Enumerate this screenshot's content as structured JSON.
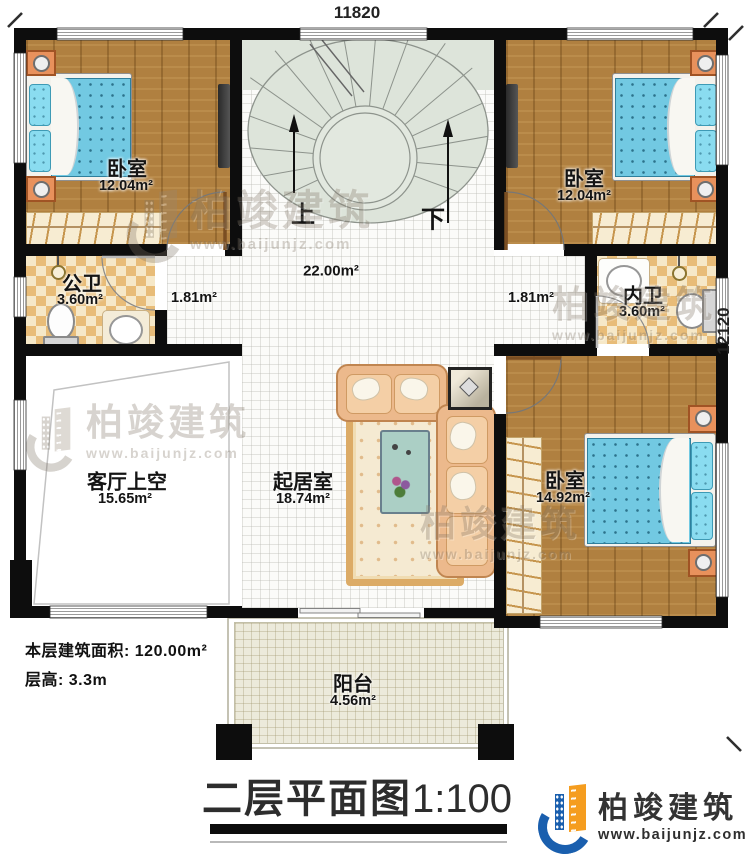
{
  "dimensions": {
    "top": "11820",
    "right": "12120"
  },
  "stair": {
    "up": "上",
    "down": "下"
  },
  "areas": {
    "stair_hall": "22.00m²",
    "hall_left": "1.81m²",
    "hall_right": "1.81m²"
  },
  "rooms": {
    "bedroom_tl": {
      "label": "卧室",
      "area": "12.04m²"
    },
    "bedroom_tr": {
      "label": "卧室",
      "area": "12.04m²"
    },
    "bedroom_br": {
      "label": "卧室",
      "area": "14.92m²"
    },
    "public_bath": {
      "label": "公卫",
      "area": "3.60m²"
    },
    "ensuite_bath": {
      "label": "内卫",
      "area": "3.60m²"
    },
    "living_void": {
      "label": "客厅上空",
      "area": "15.65m²"
    },
    "family_room": {
      "label": "起居室",
      "area": "18.74m²"
    },
    "balcony": {
      "label": "阳台",
      "area": "4.56m²"
    }
  },
  "info": {
    "floor_area": "本层建筑面积: 120.00m²",
    "floor_height": "层高: 3.3m"
  },
  "title": {
    "main": "二层平面图",
    "scale": "1:100"
  },
  "brand": {
    "name": "柏竣建筑",
    "site": "www.baijunjz.com"
  },
  "watermark": {
    "name": "柏竣建筑",
    "site": "www.baijunjz.com"
  },
  "colors": {
    "accent_blue": "#1a5fae",
    "accent_orange": "#f59d1f",
    "wall": "#0d0d0d"
  }
}
